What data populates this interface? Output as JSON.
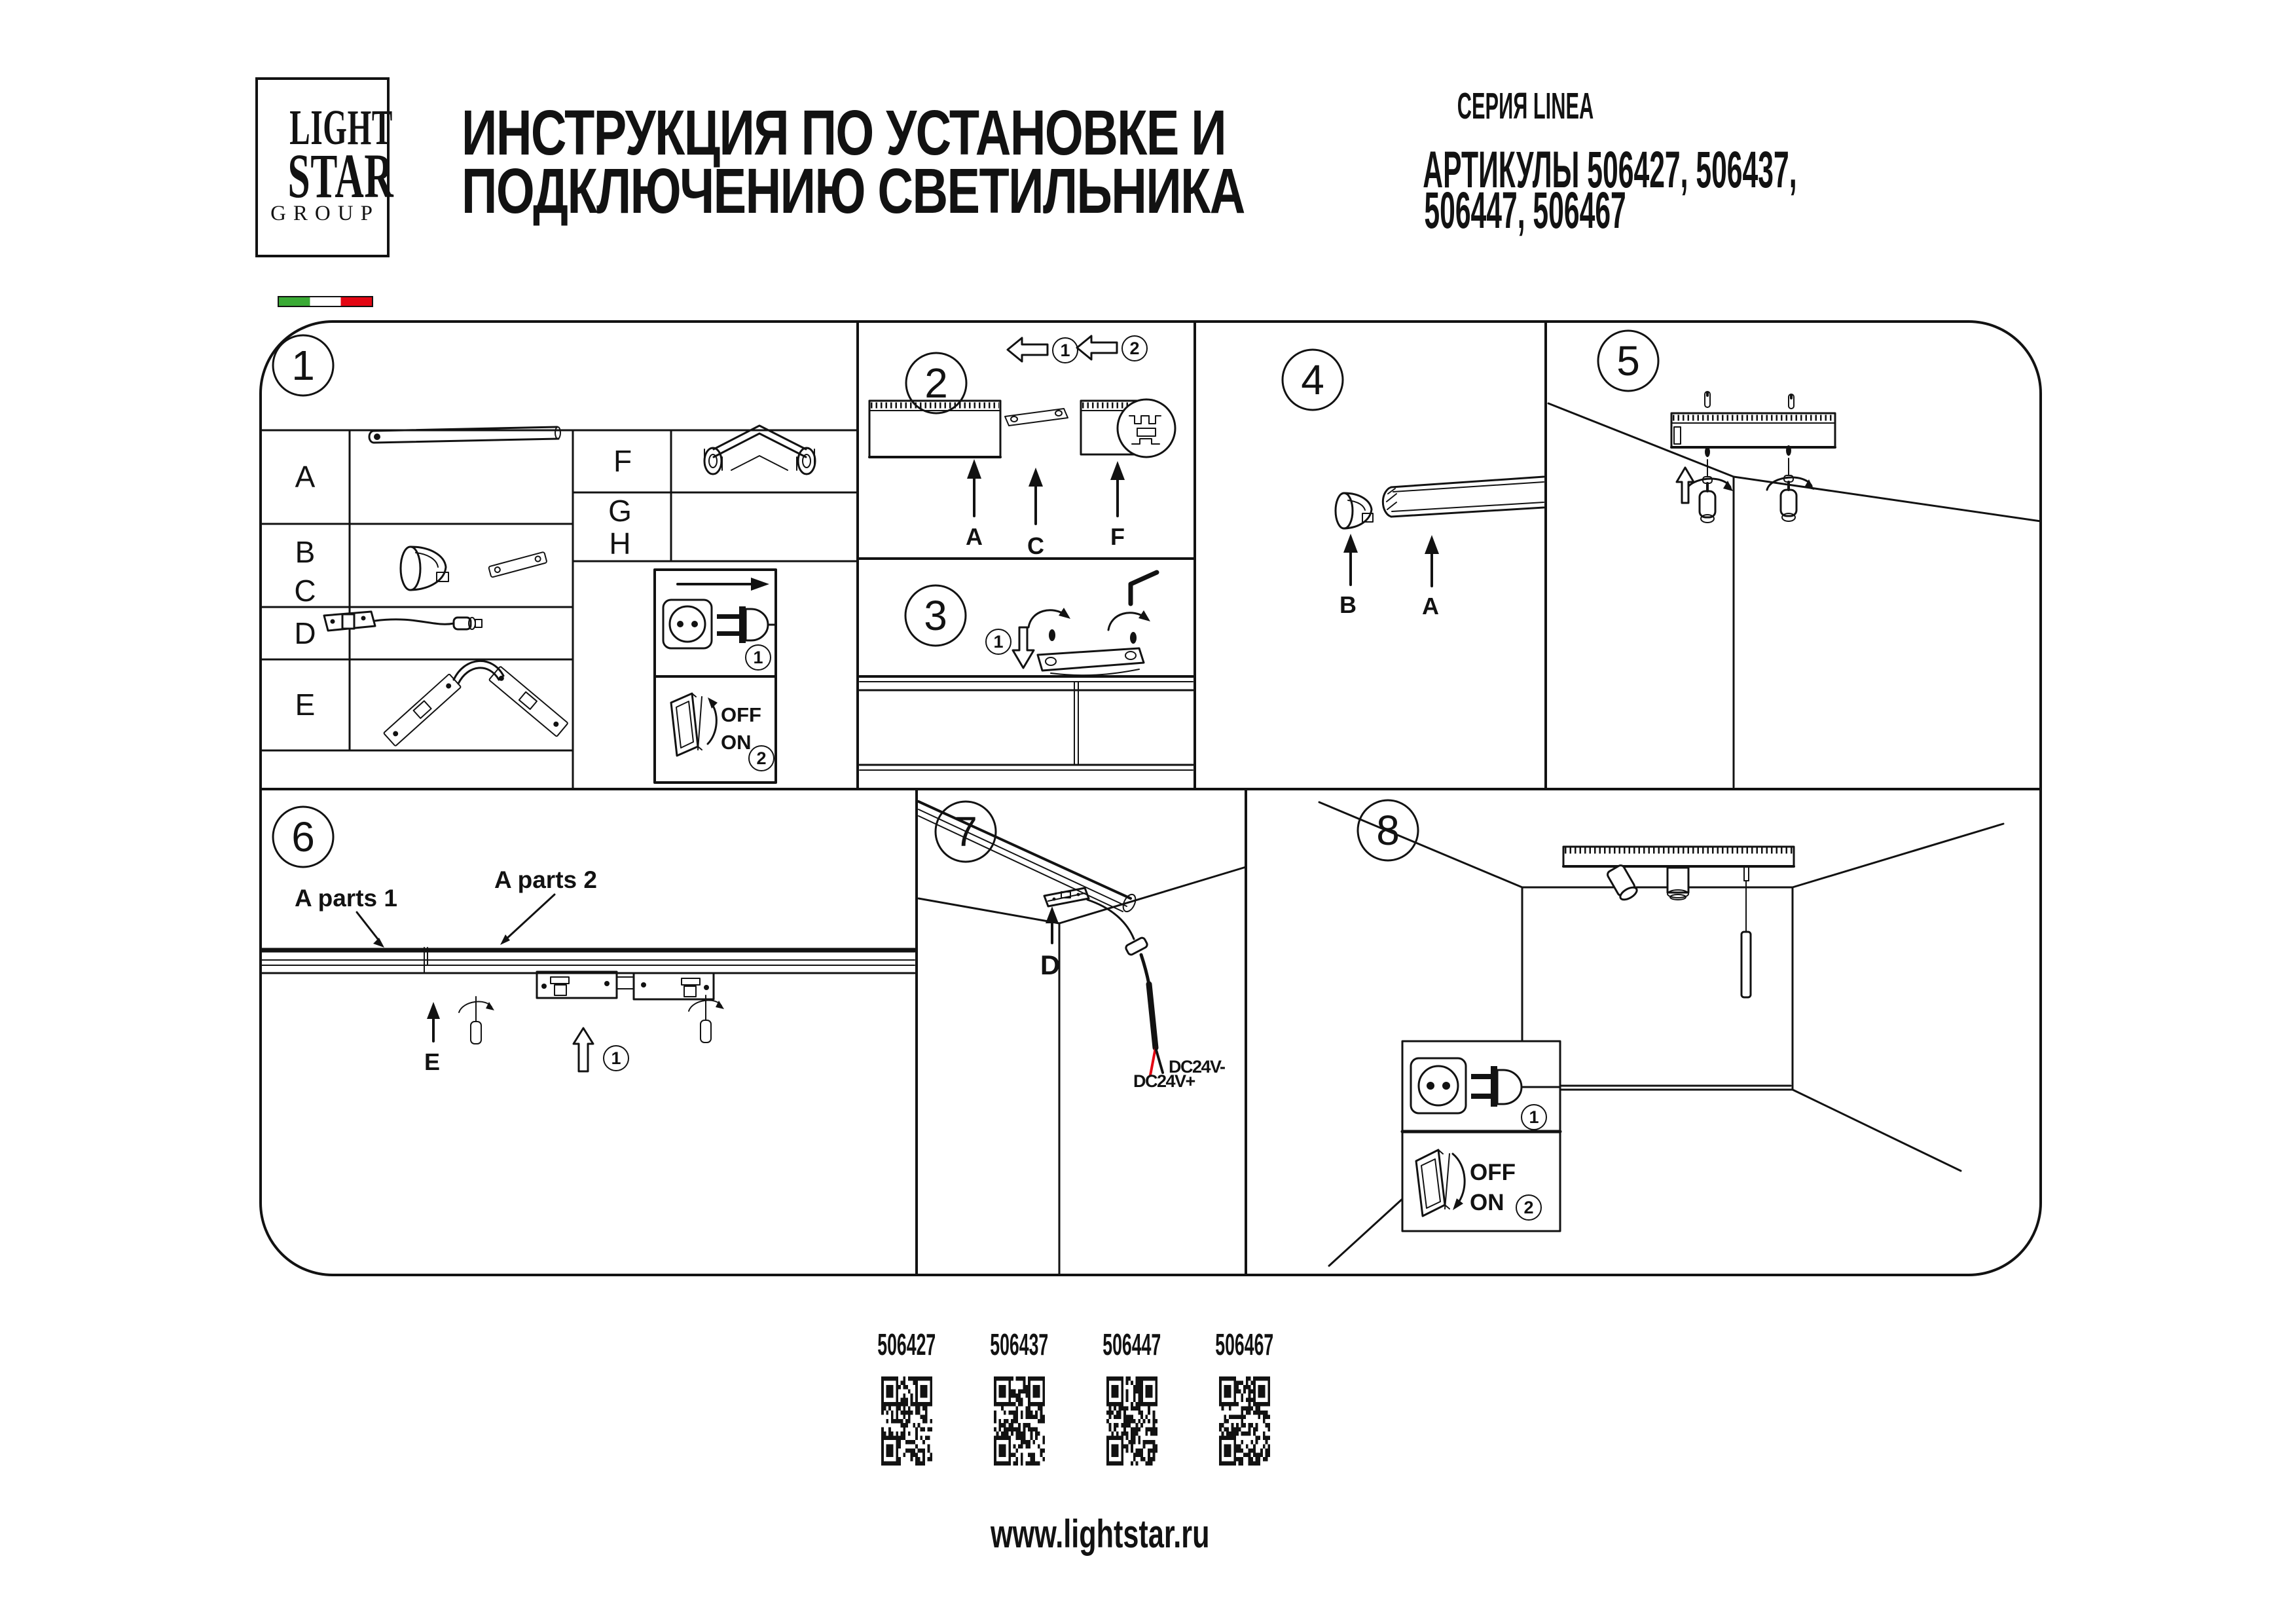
{
  "logo": {
    "line1": "LIGHT",
    "line2": "STAR",
    "line3": "GROUP"
  },
  "header": {
    "title_line1": "ИНСТРУКЦИЯ ПО УСТАНОВКЕ И",
    "title_line2": "ПОДКЛЮЧЕНИЮ СВЕТИЛЬНИКА",
    "series": "СЕРИЯ LINEA",
    "articles_line1": "АРТИКУЛЫ 506427, 506437,",
    "articles_line2": "506447, 506467"
  },
  "panels": {
    "p1": {
      "num": "1",
      "rows": {
        "a": "A",
        "b": "B",
        "c": "C",
        "d": "D",
        "e": "E",
        "f": "F",
        "g": "G",
        "h": "H"
      },
      "power": {
        "step1": "1",
        "step2": "2",
        "off": "OFF",
        "on": "ON"
      }
    },
    "p2": {
      "num": "2",
      "step1": "1",
      "step2": "2",
      "label_a": "A",
      "label_c": "C",
      "label_f": "F"
    },
    "p3": {
      "num": "3",
      "step1": "1"
    },
    "p4": {
      "num": "4",
      "label_b": "B",
      "label_a": "A"
    },
    "p5": {
      "num": "5"
    },
    "p6": {
      "num": "6",
      "label_parts1": "A parts 1",
      "label_parts2": "A parts 2",
      "label_e": "E",
      "step1": "1"
    },
    "p7": {
      "num": "7",
      "label_d": "D",
      "label_dc_minus": "DC24V-",
      "label_dc_plus": "DC24V+"
    },
    "p8": {
      "num": "8",
      "step1": "1",
      "step2": "2",
      "off": "OFF",
      "on": "ON"
    }
  },
  "qr_items": [
    {
      "code": "506427"
    },
    {
      "code": "506437"
    },
    {
      "code": "506447"
    },
    {
      "code": "506467"
    }
  ],
  "footer": {
    "url": "www.lightstar.ru"
  }
}
